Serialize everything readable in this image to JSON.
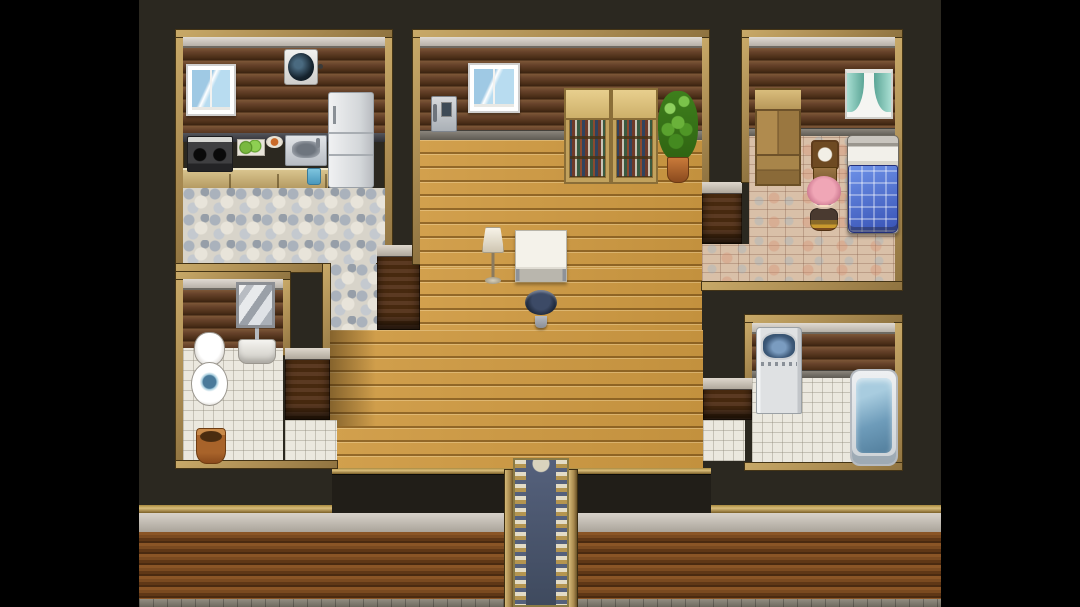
{
  "meta": {
    "title": "RPG top-down house interior map",
    "engine_style": "rpg-maker",
    "visible_text": "none",
    "view": "top-down tile map with black letterbox bars left and right"
  },
  "palette": {
    "letterbox": "#000000",
    "background": "#2b2820",
    "room_frame": "#ab8c52",
    "wall_planks_dark": "#5e3b22",
    "wood_floor": "#cf9a42",
    "pebble_floor": "#d8d4ca",
    "white_tile_floor": "#ebe8df",
    "brick_floor": "#d9c0a8",
    "ceiling_trim": "#ccc6bf",
    "carpet_blue": "#4a566c",
    "carpet_gold": "#c3ae74",
    "bed_quilt_blue": "#4a6fd4",
    "curtain_teal": "#7fc4b8",
    "plant_green": "#5aa22e",
    "character_hair_pink": "#f0a6b6"
  },
  "rooms": [
    {
      "name": "kitchen",
      "position": "top-left",
      "floor": "pebble-stone",
      "contents": [
        "window",
        "ventilation-fan",
        "stove",
        "cutting-board",
        "food-plate",
        "kitchen-sink",
        "refrigerator",
        "counter",
        "cup"
      ]
    },
    {
      "name": "living-room",
      "position": "center",
      "floor": "wood-plank",
      "contents": [
        "wall-phone",
        "window",
        "bookshelf",
        "bookshelf",
        "potted-plant",
        "floor-lamp",
        "table",
        "stool"
      ]
    },
    {
      "name": "bedroom",
      "position": "top-right",
      "floor": "brick-parquet",
      "contents": [
        "wardrobe",
        "curtain-window",
        "clock",
        "bed",
        "player-character"
      ]
    },
    {
      "name": "bathroom",
      "position": "bottom-left",
      "floor": "white-tile",
      "contents": [
        "mirror",
        "bathroom-sink",
        "toilet",
        "basket"
      ]
    },
    {
      "name": "laundry-bath",
      "position": "bottom-right",
      "floor": "white-tile",
      "contents": [
        "washing-machine",
        "bathtub"
      ]
    },
    {
      "name": "entrance",
      "position": "bottom-center",
      "floor": "ornate-carpet",
      "contents": [
        "entrance-carpet"
      ]
    }
  ],
  "surfaces": [
    {
      "name": "game-background",
      "cls": "gamebg",
      "x": 139,
      "y": 0,
      "w": 802,
      "h": 607,
      "i": false
    },
    {
      "name": "south-wall-gold-trim",
      "cls": "goldtrim",
      "x": 139,
      "y": 505,
      "w": 802,
      "h": 8,
      "i": false
    },
    {
      "name": "south-wall-plaster-band",
      "cls": "plaster",
      "x": 139,
      "y": 513,
      "w": 802,
      "h": 19,
      "i": false
    },
    {
      "name": "south-wall-planks",
      "cls": "splanks",
      "x": 139,
      "y": 532,
      "w": 802,
      "h": 67,
      "i": false
    },
    {
      "name": "south-wall-stone-base",
      "cls": "stonebase",
      "x": 139,
      "y": 599,
      "w": 802,
      "h": 8,
      "i": false
    },
    {
      "name": "hall-south-wall-trim",
      "cls": "goldtrim",
      "x": 332,
      "y": 468,
      "w": 379,
      "h": 6,
      "i": false
    },
    {
      "name": "hall-south-wall-face",
      "cls": "darkface",
      "x": 332,
      "y": 474,
      "w": 379,
      "h": 39,
      "i": false
    },
    {
      "name": "kitchen-frame-top",
      "cls": "frame",
      "x": 176,
      "y": 30,
      "w": 216,
      "h": 8,
      "i": false
    },
    {
      "name": "kitchen-frame-left",
      "cls": "frame",
      "x": 176,
      "y": 38,
      "w": 7,
      "h": 234,
      "i": false
    },
    {
      "name": "kitchen-frame-right",
      "cls": "frame",
      "x": 385,
      "y": 38,
      "w": 7,
      "h": 226,
      "i": false
    },
    {
      "name": "kitchen-ceiling-trim",
      "cls": "trim",
      "x": 183,
      "y": 37,
      "w": 202,
      "h": 11,
      "i": false
    },
    {
      "name": "kitchen-wall",
      "cls": "darkwall",
      "x": 183,
      "y": 48,
      "w": 202,
      "h": 85,
      "i": false
    },
    {
      "name": "kitchen-counter-top",
      "cls": "countertop",
      "x": 183,
      "y": 133,
      "w": 202,
      "h": 9,
      "i": false
    },
    {
      "name": "kitchen-counter-front",
      "cls": "counterfront",
      "x": 183,
      "y": 168,
      "w": 145,
      "h": 20,
      "i": true
    },
    {
      "name": "kitchen-floor",
      "cls": "pebble",
      "x": 183,
      "y": 188,
      "w": 202,
      "h": 76,
      "i": true
    },
    {
      "name": "kitchen-frame-bottom-left",
      "cls": "frame",
      "x": 176,
      "y": 264,
      "w": 154,
      "h": 8,
      "i": false
    },
    {
      "name": "kitchen-frame-bottom-right",
      "cls": "frame",
      "x": 377,
      "y": 264,
      "w": 15,
      "h": 8,
      "i": false
    },
    {
      "name": "corridor-kitchen-floor",
      "cls": "pebble",
      "x": 330,
      "y": 264,
      "w": 47,
      "h": 66,
      "i": true
    },
    {
      "name": "corridor-frame-left",
      "cls": "frame",
      "x": 323,
      "y": 264,
      "w": 7,
      "h": 109,
      "i": false
    },
    {
      "name": "corridor-wall-top",
      "cls": "walltop",
      "x": 377,
      "y": 245,
      "w": 43,
      "h": 85,
      "i": false
    },
    {
      "name": "living-frame-top",
      "cls": "frame",
      "x": 413,
      "y": 30,
      "w": 296,
      "h": 8,
      "i": false
    },
    {
      "name": "living-frame-left",
      "cls": "frame",
      "x": 413,
      "y": 38,
      "w": 7,
      "h": 226,
      "i": false
    },
    {
      "name": "living-frame-right",
      "cls": "frame",
      "x": 702,
      "y": 38,
      "w": 7,
      "h": 144,
      "i": false
    },
    {
      "name": "living-ceiling-trim",
      "cls": "trim",
      "x": 420,
      "y": 37,
      "w": 282,
      "h": 11,
      "i": false
    },
    {
      "name": "living-wall",
      "cls": "darkwall",
      "x": 420,
      "y": 48,
      "w": 282,
      "h": 82,
      "i": false
    },
    {
      "name": "living-baseboard",
      "cls": "baseboard",
      "x": 420,
      "y": 130,
      "w": 282,
      "h": 10,
      "i": false
    },
    {
      "name": "living-floor-upper",
      "cls": "woodfloor",
      "x": 420,
      "y": 140,
      "w": 282,
      "h": 128,
      "i": true
    },
    {
      "name": "living-floor-middle",
      "cls": "woodfloor",
      "x": 420,
      "y": 268,
      "w": 282,
      "h": 62,
      "i": true
    },
    {
      "name": "living-floor-lower",
      "cls": "woodfloor",
      "x": 330,
      "y": 330,
      "w": 373,
      "h": 138,
      "i": true
    },
    {
      "name": "living-floor-shadow",
      "cls": "shadow",
      "x": 330,
      "y": 330,
      "w": 46,
      "h": 96,
      "i": false
    },
    {
      "name": "bedroom-doorway-wall-top",
      "cls": "walltop",
      "x": 702,
      "y": 182,
      "w": 40,
      "h": 62,
      "i": false
    },
    {
      "name": "bedroom-passage-floor",
      "cls": "brickfloor",
      "x": 702,
      "y": 244,
      "w": 47,
      "h": 38,
      "i": true
    },
    {
      "name": "bedroom-frame-top",
      "cls": "frame",
      "x": 742,
      "y": 30,
      "w": 160,
      "h": 8,
      "i": false
    },
    {
      "name": "bedroom-frame-left",
      "cls": "frame",
      "x": 742,
      "y": 38,
      "w": 7,
      "h": 144,
      "i": false
    },
    {
      "name": "bedroom-frame-right",
      "cls": "frame",
      "x": 895,
      "y": 38,
      "w": 7,
      "h": 252,
      "i": false
    },
    {
      "name": "bedroom-ceiling-trim",
      "cls": "trim",
      "x": 749,
      "y": 37,
      "w": 146,
      "h": 11,
      "i": false
    },
    {
      "name": "bedroom-wall",
      "cls": "darkwall",
      "x": 749,
      "y": 48,
      "w": 146,
      "h": 80,
      "i": false
    },
    {
      "name": "bedroom-baseboard",
      "cls": "baseboard",
      "x": 749,
      "y": 128,
      "w": 146,
      "h": 8,
      "i": false
    },
    {
      "name": "bedroom-floor",
      "cls": "brickfloor",
      "x": 749,
      "y": 136,
      "w": 146,
      "h": 146,
      "i": true
    },
    {
      "name": "bedroom-frame-bottom",
      "cls": "frame",
      "x": 702,
      "y": 282,
      "w": 200,
      "h": 8,
      "i": false
    },
    {
      "name": "bathroom-frame-top",
      "cls": "frame",
      "x": 176,
      "y": 272,
      "w": 114,
      "h": 8,
      "i": false
    },
    {
      "name": "bathroom-frame-left",
      "cls": "frame",
      "x": 176,
      "y": 280,
      "w": 7,
      "h": 188,
      "i": false
    },
    {
      "name": "bathroom-frame-right",
      "cls": "frame",
      "x": 283,
      "y": 280,
      "w": 7,
      "h": 75,
      "i": false
    },
    {
      "name": "bathroom-ceiling-trim",
      "cls": "trim",
      "x": 183,
      "y": 279,
      "w": 100,
      "h": 11,
      "i": false
    },
    {
      "name": "bathroom-wall",
      "cls": "darkwall",
      "x": 183,
      "y": 290,
      "w": 100,
      "h": 58,
      "i": false
    },
    {
      "name": "bathroom-floor",
      "cls": "whitetile",
      "x": 183,
      "y": 348,
      "w": 100,
      "h": 113,
      "i": true
    },
    {
      "name": "bathroom-doorway-wall-top",
      "cls": "walltop",
      "x": 285,
      "y": 348,
      "w": 45,
      "h": 72,
      "i": false
    },
    {
      "name": "bathroom-passage-floor",
      "cls": "whitetile",
      "x": 285,
      "y": 420,
      "w": 52,
      "h": 41,
      "i": true
    },
    {
      "name": "bathroom-frame-bottom",
      "cls": "frame",
      "x": 176,
      "y": 461,
      "w": 161,
      "h": 7,
      "i": false
    },
    {
      "name": "laundry-frame-top",
      "cls": "frame",
      "x": 745,
      "y": 315,
      "w": 157,
      "h": 8,
      "i": false
    },
    {
      "name": "laundry-frame-left",
      "cls": "frame",
      "x": 745,
      "y": 323,
      "w": 7,
      "h": 72,
      "i": false
    },
    {
      "name": "laundry-frame-right",
      "cls": "frame",
      "x": 895,
      "y": 323,
      "w": 7,
      "h": 147,
      "i": false
    },
    {
      "name": "laundry-ceiling-trim",
      "cls": "trim",
      "x": 752,
      "y": 323,
      "w": 143,
      "h": 11,
      "i": false
    },
    {
      "name": "laundry-wall",
      "cls": "darkwall",
      "x": 752,
      "y": 334,
      "w": 143,
      "h": 36,
      "i": false
    },
    {
      "name": "laundry-baseboard",
      "cls": "baseboard",
      "x": 752,
      "y": 370,
      "w": 143,
      "h": 8,
      "i": false
    },
    {
      "name": "laundry-floor",
      "cls": "whitetile",
      "x": 752,
      "y": 378,
      "w": 143,
      "h": 85,
      "i": true
    },
    {
      "name": "laundry-doorway-wall-top",
      "cls": "walltop",
      "x": 703,
      "y": 378,
      "w": 49,
      "h": 42,
      "i": false
    },
    {
      "name": "laundry-passage-floor",
      "cls": "whitetile",
      "x": 703,
      "y": 420,
      "w": 42,
      "h": 41,
      "i": true
    },
    {
      "name": "laundry-frame-bottom",
      "cls": "frame",
      "x": 745,
      "y": 463,
      "w": 157,
      "h": 7,
      "i": false
    },
    {
      "name": "entrance-door-post-left",
      "cls": "post",
      "x": 505,
      "y": 470,
      "w": 8,
      "h": 137,
      "i": false
    },
    {
      "name": "entrance-door-post-right",
      "cls": "post",
      "x": 569,
      "y": 470,
      "w": 8,
      "h": 137,
      "i": false
    },
    {
      "name": "entrance-carpet",
      "cls": "carpet",
      "x": 513,
      "y": 458,
      "w": 56,
      "h": 149,
      "i": true
    },
    {
      "name": "letterbox-left",
      "cls": "lbox",
      "x": 0,
      "y": 0,
      "w": 139,
      "h": 607,
      "i": false
    },
    {
      "name": "letterbox-right",
      "cls": "lbox",
      "x": 941,
      "y": 0,
      "w": 139,
      "h": 607,
      "i": false
    }
  ],
  "objects": [
    {
      "name": "kitchen-window",
      "cls": "winblue",
      "x": 186,
      "y": 64,
      "w": 50,
      "h": 52,
      "i": false
    },
    {
      "name": "ventilation-fan",
      "cls": "fan",
      "x": 284,
      "y": 49,
      "w": 34,
      "h": 36,
      "i": false
    },
    {
      "name": "stove",
      "cls": "stove",
      "x": 187,
      "y": 136,
      "w": 46,
      "h": 36,
      "i": true
    },
    {
      "name": "cutting-board",
      "cls": "board",
      "x": 237,
      "y": 139,
      "w": 28,
      "h": 17,
      "i": true
    },
    {
      "name": "food-plate",
      "cls": "plate",
      "x": 266,
      "y": 136,
      "w": 17,
      "h": 12,
      "i": true
    },
    {
      "name": "kitchen-sink",
      "cls": "ksink",
      "x": 285,
      "y": 135,
      "w": 42,
      "h": 31,
      "i": true
    },
    {
      "name": "refrigerator",
      "cls": "fridge",
      "x": 328,
      "y": 92,
      "w": 46,
      "h": 96,
      "i": true
    },
    {
      "name": "cup",
      "cls": "cup",
      "x": 307,
      "y": 168,
      "w": 14,
      "h": 17,
      "i": true
    },
    {
      "name": "wall-phone",
      "cls": "phone",
      "x": 431,
      "y": 96,
      "w": 26,
      "h": 36,
      "i": true
    },
    {
      "name": "living-window",
      "cls": "winblue",
      "x": 468,
      "y": 63,
      "w": 52,
      "h": 50,
      "i": false
    },
    {
      "name": "bookshelf-left",
      "cls": "bookshelf",
      "x": 564,
      "y": 88,
      "w": 47,
      "h": 96,
      "i": true
    },
    {
      "name": "bookshelf-right",
      "cls": "bookshelf",
      "x": 611,
      "y": 88,
      "w": 47,
      "h": 96,
      "i": true
    },
    {
      "name": "potted-plant",
      "cls": "plant",
      "x": 658,
      "y": 91,
      "w": 40,
      "h": 92,
      "i": true
    },
    {
      "name": "floor-lamp",
      "cls": "lamp",
      "x": 478,
      "y": 227,
      "w": 30,
      "h": 57,
      "i": true
    },
    {
      "name": "table",
      "cls": "table",
      "x": 515,
      "y": 230,
      "w": 52,
      "h": 52,
      "i": true
    },
    {
      "name": "stool",
      "cls": "stool",
      "x": 525,
      "y": 290,
      "w": 32,
      "h": 38,
      "i": true
    },
    {
      "name": "wardrobe",
      "cls": "wardrobe",
      "x": 755,
      "y": 88,
      "w": 46,
      "h": 98,
      "i": true
    },
    {
      "name": "bedroom-curtain-window",
      "cls": "wincurtain",
      "x": 845,
      "y": 69,
      "w": 48,
      "h": 50,
      "i": false
    },
    {
      "name": "clock",
      "cls": "clock",
      "x": 811,
      "y": 140,
      "w": 28,
      "h": 45,
      "i": true
    },
    {
      "name": "bed",
      "cls": "bed",
      "x": 847,
      "y": 135,
      "w": 52,
      "h": 99,
      "i": true
    },
    {
      "name": "mirror",
      "cls": "mirror",
      "x": 236,
      "y": 282,
      "w": 39,
      "h": 46,
      "i": true
    },
    {
      "name": "bathroom-sink",
      "cls": "bsink",
      "x": 238,
      "y": 328,
      "w": 38,
      "h": 42,
      "i": true
    },
    {
      "name": "toilet",
      "cls": "toilet",
      "x": 191,
      "y": 332,
      "w": 37,
      "h": 76,
      "i": true
    },
    {
      "name": "basket",
      "cls": "basket",
      "x": 196,
      "y": 428,
      "w": 30,
      "h": 36,
      "i": true
    },
    {
      "name": "washing-machine",
      "cls": "washer",
      "x": 756,
      "y": 327,
      "w": 46,
      "h": 87,
      "i": true
    },
    {
      "name": "bathtub",
      "cls": "tub",
      "x": 850,
      "y": 369,
      "w": 48,
      "h": 97,
      "i": true
    },
    {
      "name": "player-character",
      "cls": "character",
      "x": 805,
      "y": 174,
      "w": 38,
      "h": 58,
      "i": true,
      "parts": [
        "char-body",
        "char-face",
        "char-hair"
      ]
    }
  ]
}
